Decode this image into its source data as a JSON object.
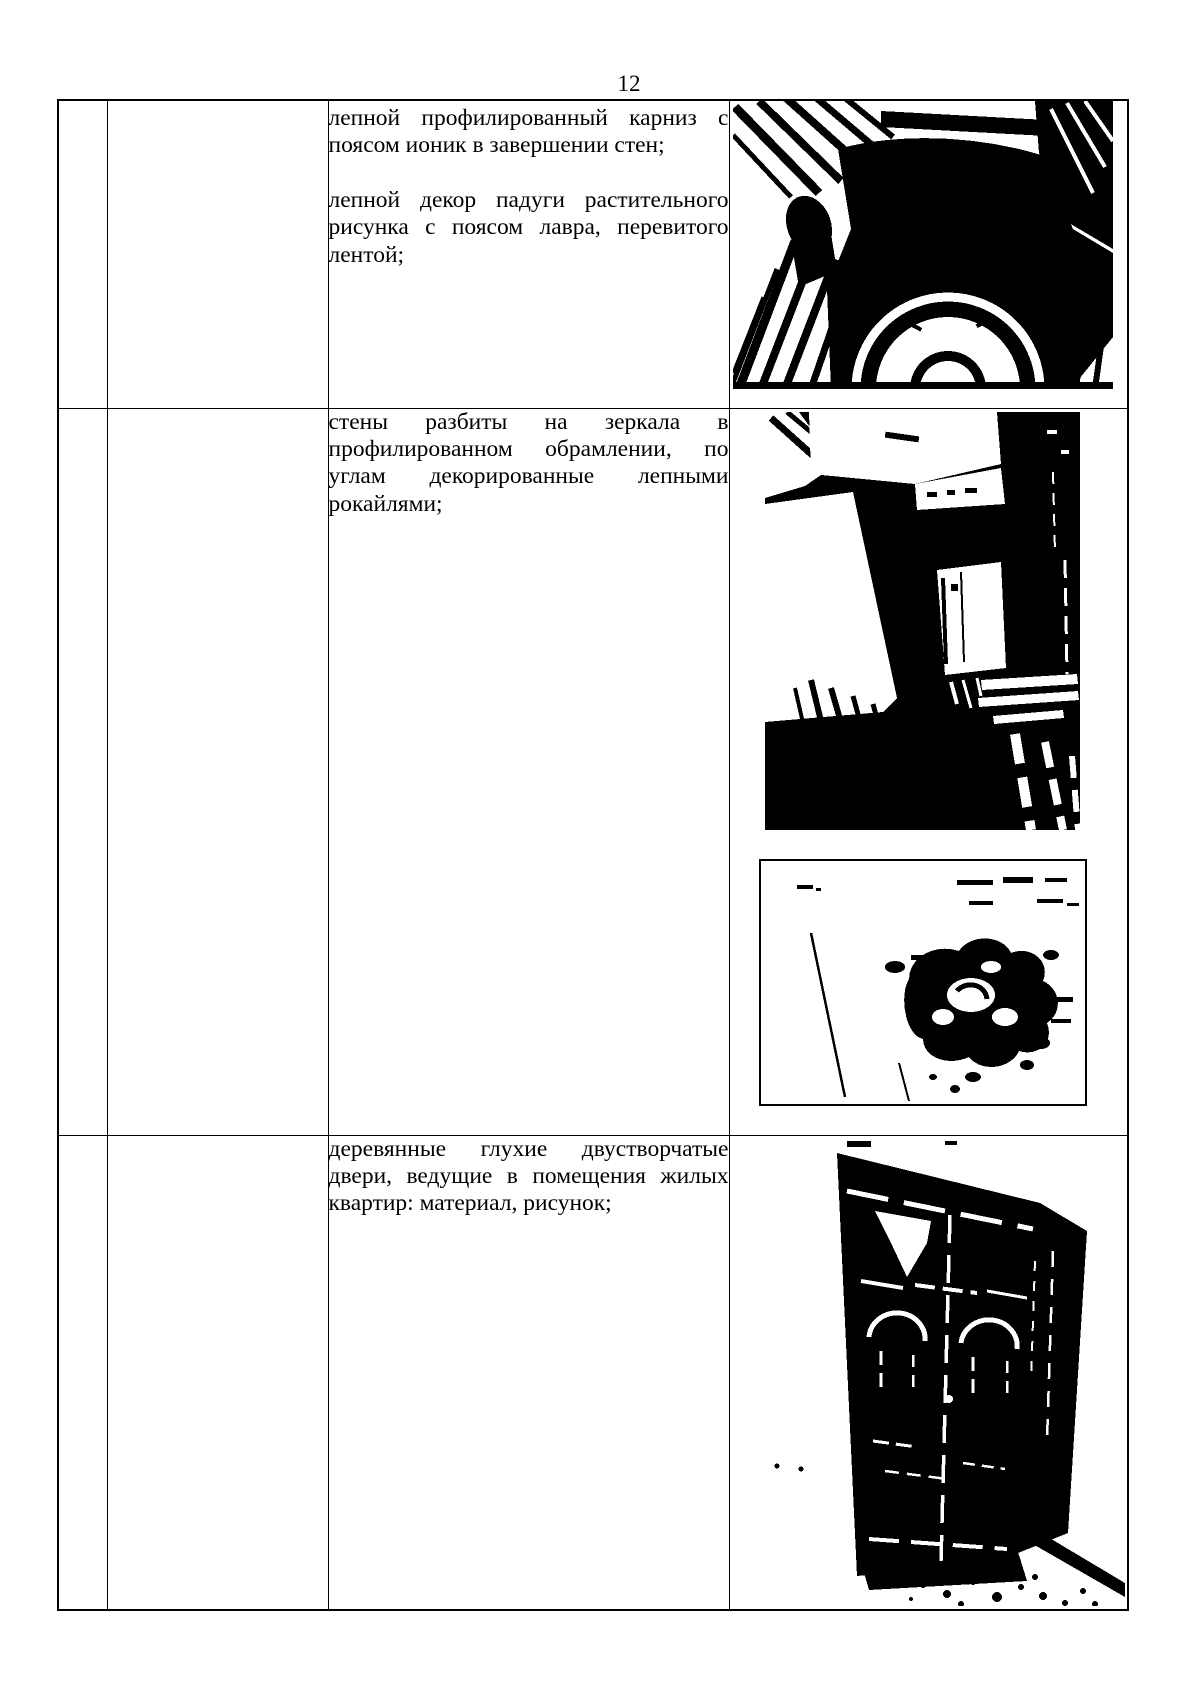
{
  "page": {
    "number": "12"
  },
  "table": {
    "rows": [
      {
        "paragraphs": [
          "лепной профилированный карниз с поясом ионик  в завершении стен;",
          "лепной декор падуги растительного рисунка с поясом лавра, перевитого лентой;"
        ],
        "photos": [
          "ceiling-cove-cornice-photo"
        ]
      },
      {
        "paragraphs": [
          "стены разбиты на зеркала в профилированном обрамлении, по углам декорированные лепными рокайлями;"
        ],
        "photos": [
          "wall-mirror-panels-photo",
          "rocaille-stucco-detail-photo"
        ]
      },
      {
        "paragraphs": [
          "деревянные глухие двустворчатые двери, ведущие в помещения жилых квартир: материал, рисунок;"
        ],
        "photos": [
          "wooden-double-doors-photo"
        ]
      }
    ]
  }
}
